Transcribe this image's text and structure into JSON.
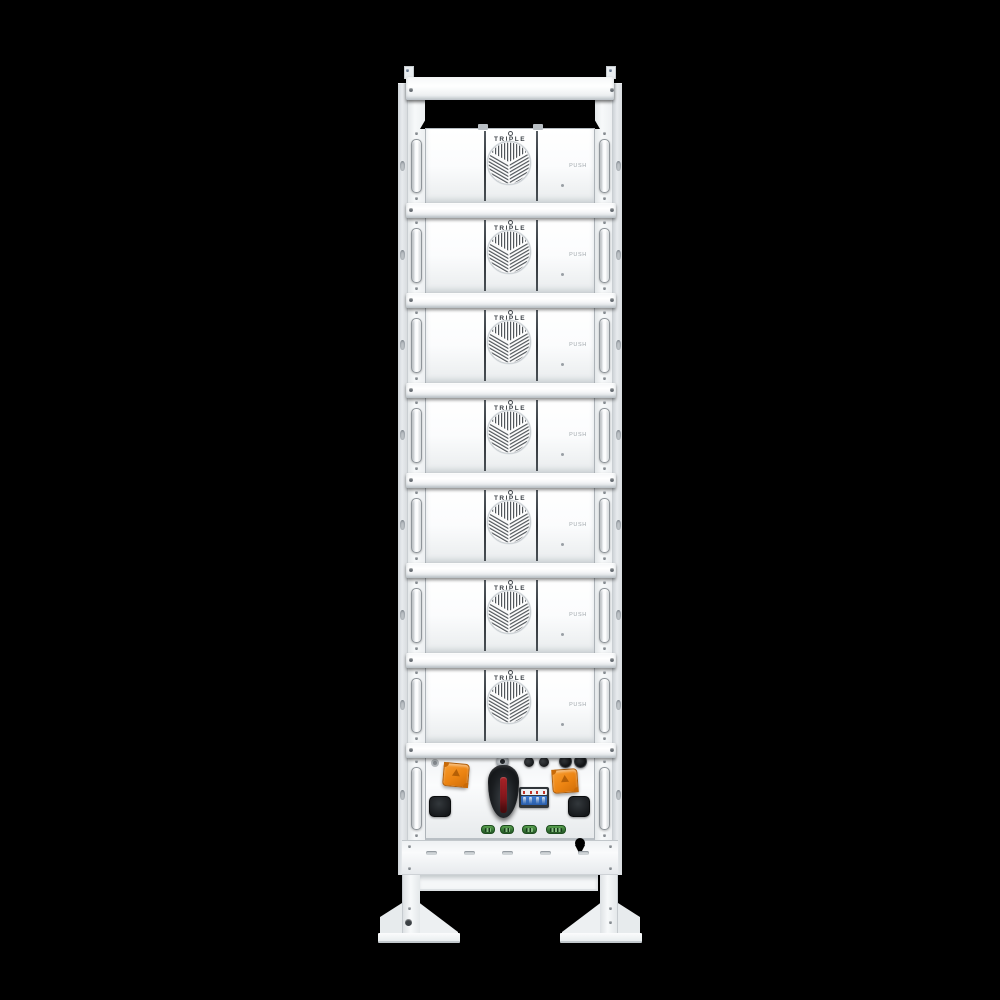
{
  "image_type": "product-photo",
  "subject": "stacked battery storage rack with seven battery modules and a control unit on a floor stand",
  "background_color": "#000000",
  "rack": {
    "modules": [
      {
        "brand": "TRIPLE",
        "brand_sub": "POWER",
        "push_label": "PUSH"
      },
      {
        "brand": "TRIPLE",
        "brand_sub": "POWER",
        "push_label": "PUSH"
      },
      {
        "brand": "TRIPLE",
        "brand_sub": "POWER",
        "push_label": "PUSH"
      },
      {
        "brand": "TRIPLE",
        "brand_sub": "POWER",
        "push_label": "PUSH"
      },
      {
        "brand": "TRIPLE",
        "brand_sub": "POWER",
        "push_label": "PUSH"
      },
      {
        "brand": "TRIPLE",
        "brand_sub": "POWER",
        "push_label": "PUSH"
      },
      {
        "brand": "TRIPLE",
        "brand_sub": "POWER",
        "push_label": "PUSH"
      }
    ],
    "control_unit": {
      "components": [
        "mount-ring-screw",
        "orange-connector-left",
        "orange-connector-right",
        "rotary-disconnect-switch",
        "circuit-breaker-4pole",
        "small-knob-x2",
        "cable-gland-x2",
        "comm-port-left",
        "comm-port-right",
        "green-terminal-x4"
      ]
    },
    "colors": {
      "rack_white": "#f5f7f8",
      "connector_orange": "#ec8412",
      "switch_black": "#1a1d20",
      "switch_red_stripe": "#a61e24",
      "breaker_blue": "#2f6fc4",
      "breaker_red_mark": "#c03328",
      "terminal_green": "#357334",
      "fan_line_gray": "#51565b"
    }
  }
}
